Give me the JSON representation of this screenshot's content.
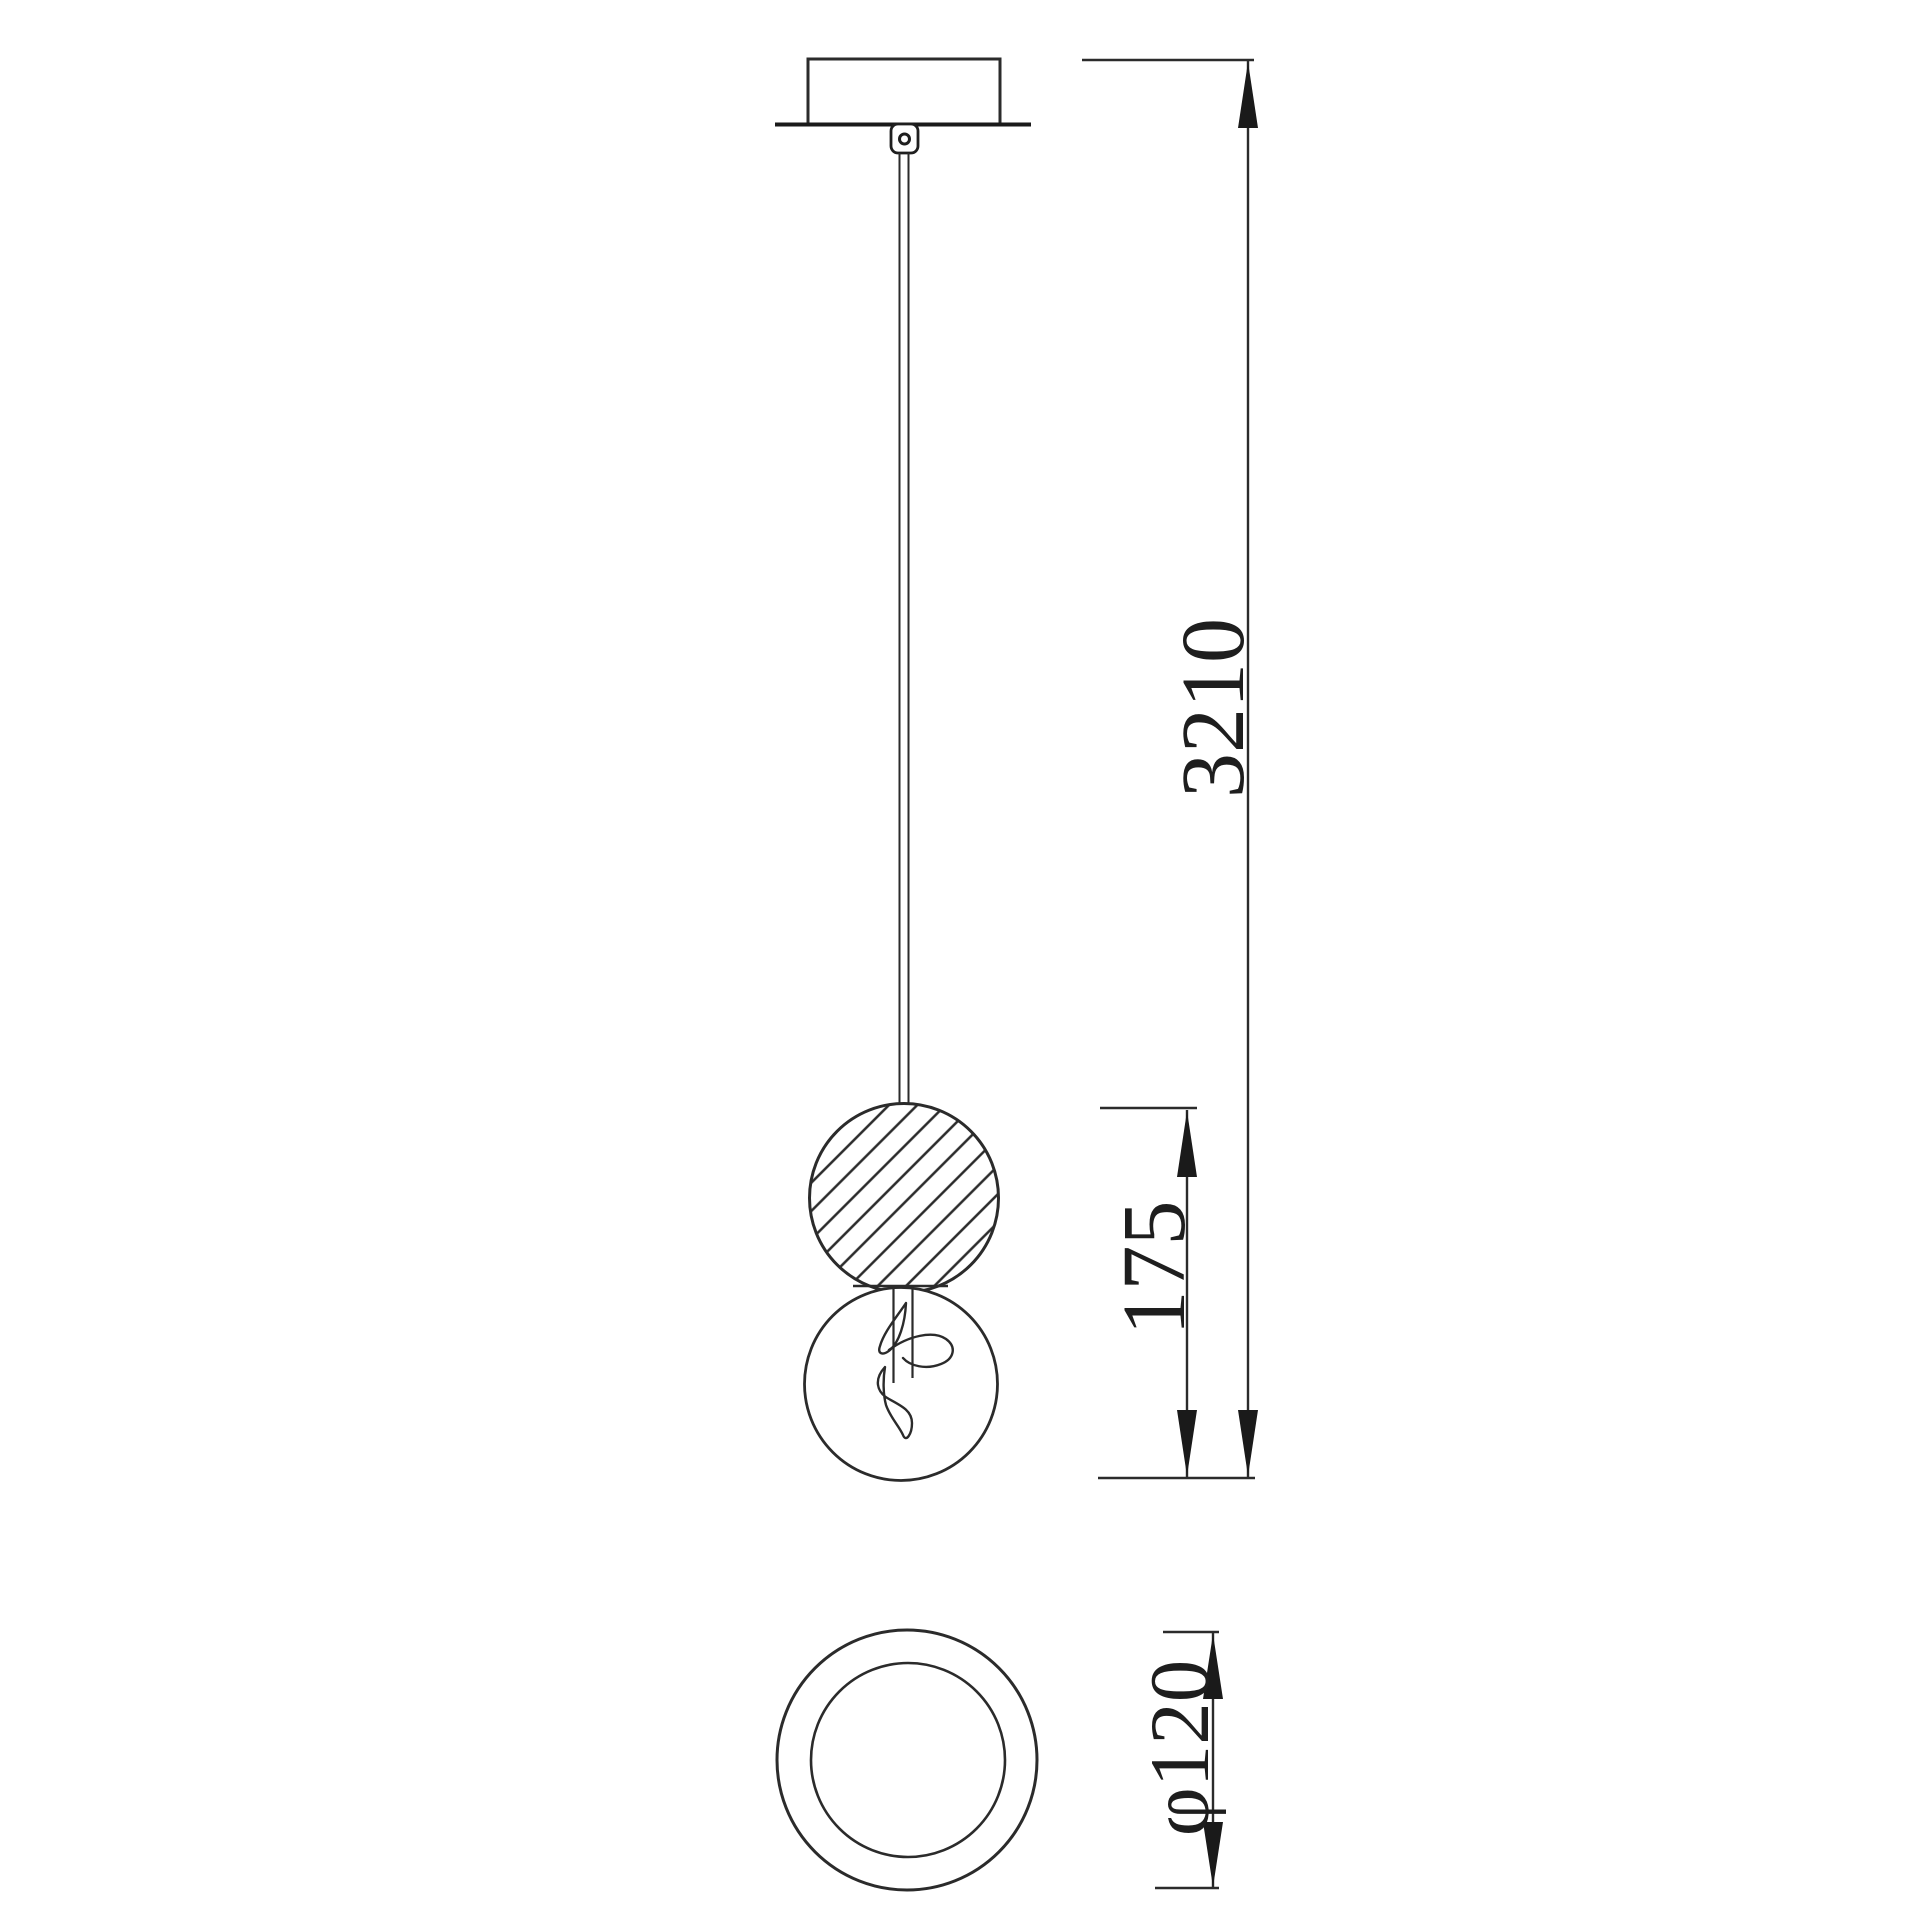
{
  "page": {
    "background": "#ffffff",
    "line_color": "#2b2b2b",
    "heavy_line_color": "#1a1a1a"
  },
  "drawing": {
    "dimensions": {
      "overall_height": "3210",
      "fixture_height": "175",
      "diameter": "φ120"
    }
  }
}
